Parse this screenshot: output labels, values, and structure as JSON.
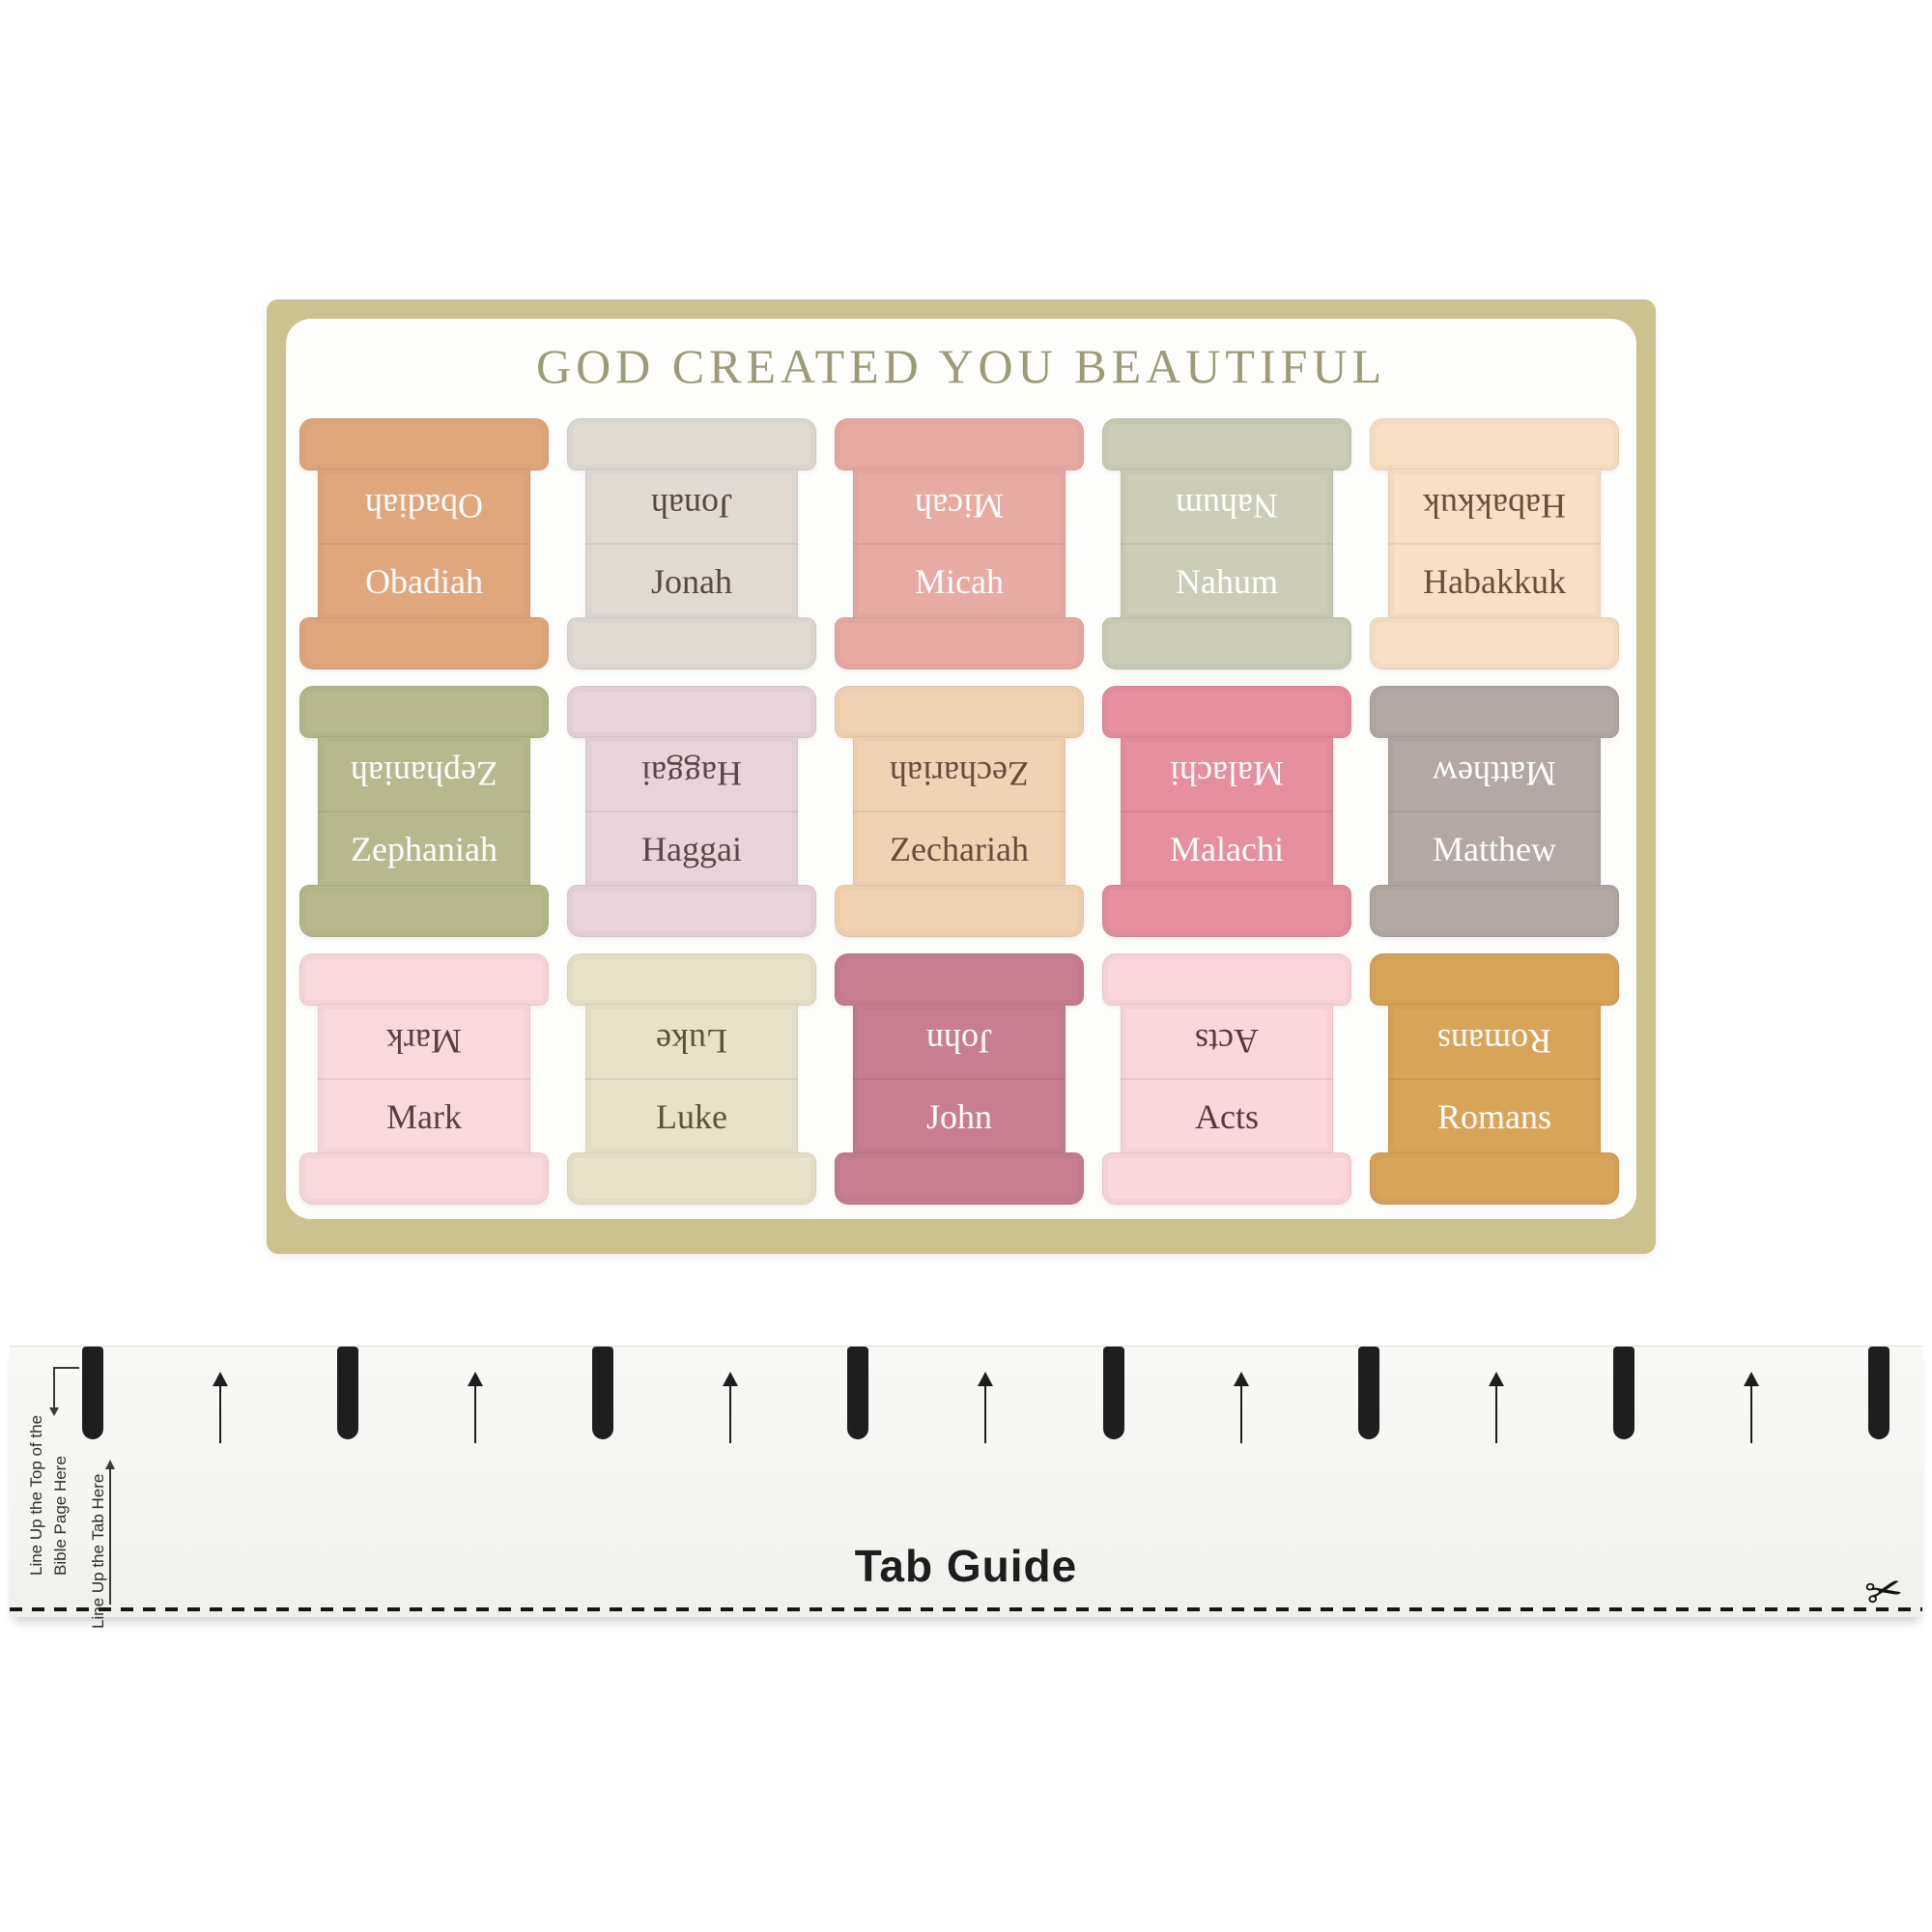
{
  "sheet": {
    "title": "GOD CREATED YOU BEAUTIFUL",
    "title_color": "#9c9a78",
    "border_color": "#cac28f",
    "background_color": "#fdfdfc",
    "tabs": [
      {
        "label": "Obadiah",
        "bg": "#e0a77c",
        "text": "#ffffff"
      },
      {
        "label": "Jonah",
        "bg": "#e1dbd4",
        "text": "#5a493d"
      },
      {
        "label": "Micah",
        "bg": "#e8aba3",
        "text": "#ffffff"
      },
      {
        "label": "Nahum",
        "bg": "#cccdb8",
        "text": "#ffffff"
      },
      {
        "label": "Habakkuk",
        "bg": "#f8e0c6",
        "text": "#6d4c38"
      },
      {
        "label": "Zephaniah",
        "bg": "#b7b98d",
        "text": "#ffffff"
      },
      {
        "label": "Haggai",
        "bg": "#e8d4db",
        "text": "#5f4449"
      },
      {
        "label": "Zechariah",
        "bg": "#f1d3b3",
        "text": "#6a4a3b"
      },
      {
        "label": "Malachi",
        "bg": "#e68f9e",
        "text": "#ffffff"
      },
      {
        "label": "Matthew",
        "bg": "#b3a8a3",
        "text": "#ffffff"
      },
      {
        "label": "Mark",
        "bg": "#f9dadc",
        "text": "#5c3f3c"
      },
      {
        "label": "Luke",
        "bg": "#e9e2ca",
        "text": "#5e5234"
      },
      {
        "label": "John",
        "bg": "#c87d90",
        "text": "#ffffff"
      },
      {
        "label": "Acts",
        "bg": "#fbd6da",
        "text": "#54383f"
      },
      {
        "label": "Romans",
        "bg": "#d8a459",
        "text": "#ffffff"
      }
    ]
  },
  "guide": {
    "title": "Tab Guide",
    "note_top_line1": "Line Up the Top of the",
    "note_top_line2": "Bible Page Here",
    "note_tab": "Line Up the Tab Here",
    "bar_count": 8,
    "arrow_count": 7,
    "bar_color": "#1e1e1e",
    "scissors_icon": "✂"
  }
}
